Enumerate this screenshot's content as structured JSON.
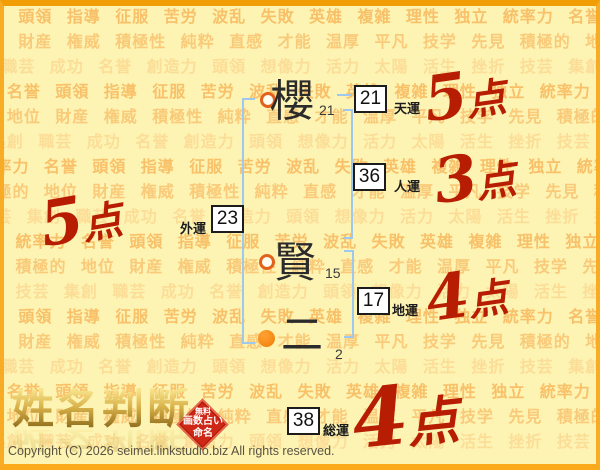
{
  "page": {
    "bg_color": "#fdf4b4",
    "border_color": "#f5a11d",
    "copyright": "Copyright (C) 2026 seimei.linkstudio.biz All rights reserved."
  },
  "watermark": {
    "color_medium": "#f8c169",
    "color_mid2": "#f9ca79",
    "color_light": "#fcdd97",
    "rows": [
      "独立 統率力 名誉 頭領 指導 征服 苦労 波乱 失敗 英雄 複雑 理性",
      "先見 積極的 地位 財産 権威 積極性 純粋 直感 才能 温厚 平凡 技学",
      "挫折 技芸 集創 職芸 成功 名誉 創造力 頭領 想像力 活力 太陽 活生"
    ]
  },
  "name": {
    "characters": [
      {
        "char": "櫻",
        "strokes": "21",
        "marker": "hollow"
      },
      {
        "char": "賢",
        "strokes": "15",
        "marker": "hollow"
      },
      {
        "char": "二",
        "strokes": "2",
        "marker": "solid"
      }
    ]
  },
  "fortunes": [
    {
      "id": "tenun",
      "value": "21",
      "label": "天運",
      "score": "5点"
    },
    {
      "id": "jinun",
      "value": "36",
      "label": "人運",
      "score": "3点"
    },
    {
      "id": "gaiun",
      "value": "23",
      "label": "外運",
      "score": "5点"
    },
    {
      "id": "chiun",
      "value": "17",
      "label": "地運",
      "score": "4点"
    },
    {
      "id": "soun",
      "value": "38",
      "label": "総運",
      "score": "4点"
    }
  ],
  "logo": {
    "title": "姓名判断",
    "badge_lines": [
      "無料",
      "画数占い",
      "命名"
    ]
  },
  "colors": {
    "score_red": "#b71d02",
    "bracket_blue": "#9fc8ef",
    "marker_orange": "#ef7e06"
  }
}
